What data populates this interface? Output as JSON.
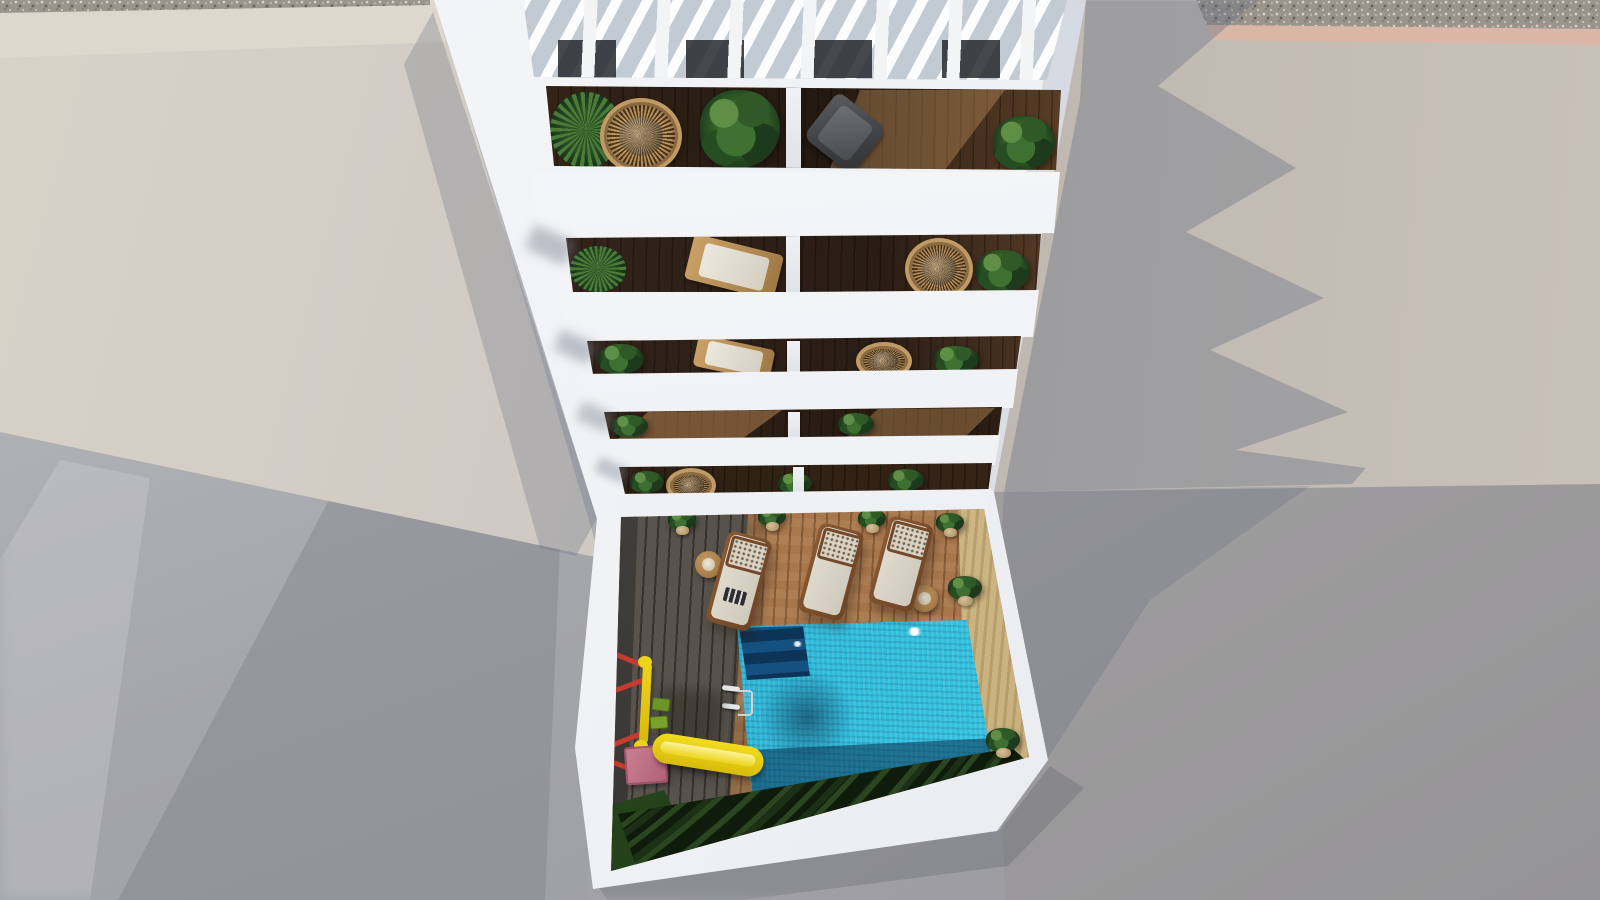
{
  "meta": {
    "description": "Aerial top-down 3D architectural render of a white apartment building with a rooftop pergola, five plant-filled balcony levels and a ground-floor courtyard containing a swimming pool, wooden deck, three sun loungers and a children's playground, surrounded by grey neighbouring rooftops",
    "view": "top-down aerial",
    "style": "photorealistic 3D render",
    "lighting": "sunlight from upper-left, long shadows cast to the right"
  },
  "palette": {
    "building_white": "#f2f3f5",
    "parapet_shade": "#dfe3e8",
    "left_roof_beige": "#cdc8c1",
    "right_roof_grey": "#beb6ae",
    "ground_grey": "#a1a1a5",
    "shadow_blue_grey": "#8f959f",
    "balcony_wood_dark": "#2a1d15",
    "balcony_wood_lit": "#93643e",
    "deck_wood_lit": "#aa784e",
    "deck_wood_shaded": "#56514a",
    "travertine": "#cfb988",
    "pool_cyan_bright": "#36c5e2",
    "pool_teal_mid": "#22a3c8",
    "pool_navy_shadow": "#16486f",
    "plant_green": "#356329",
    "rattan": "#c09a64",
    "lounger_cushion": "#e3ddd0",
    "playground_red": "#c63b2f",
    "playground_yellow": "#ecd41c",
    "slide_platform_pink": "#c27f92",
    "hedge_dark_green": "#131f0d",
    "gravel_strip": "#9b948c",
    "kerb_pink": "#d7b3a3"
  },
  "scene": {
    "building": {
      "pergola": {
        "slats": 8,
        "material": "white painted wood"
      },
      "balcony_levels": 5,
      "balcony_items": [
        "potted palms",
        "leafy plants",
        "rattan papasan chairs",
        "grey sling chair",
        "wooden sun lounger with white cushion",
        "white unit dividers",
        "dark hardwood decking"
      ]
    },
    "courtyard": {
      "pool": {
        "shape": "rectangular",
        "features": [
          "corner entry steps",
          "chrome ladder",
          "sun sparkle reflections",
          "hedge shadow along far edge"
        ]
      },
      "sun_loungers": 3,
      "side_tables": 2,
      "potted_plants": 6,
      "playground": {
        "swing_set": {
          "frame_colors": [
            "red",
            "yellow"
          ],
          "seats": 2
        },
        "slide": {
          "body_color": "yellow",
          "platform_color": "pink"
        }
      },
      "deck": "timber planks, half in building shadow",
      "hedge": "dark clipped shrubs along lower wall",
      "grass_patch": "bottom-left corner",
      "outdoor_shower": 1
    },
    "surroundings": {
      "left": "large beige concrete rooftop",
      "right": "grey rooftop and wall receiving the building's jagged balcony shadow",
      "top_edge": "pebble/gravel drainage strip with pink kerb",
      "bottom": "plain grey street / wall planes"
    }
  }
}
